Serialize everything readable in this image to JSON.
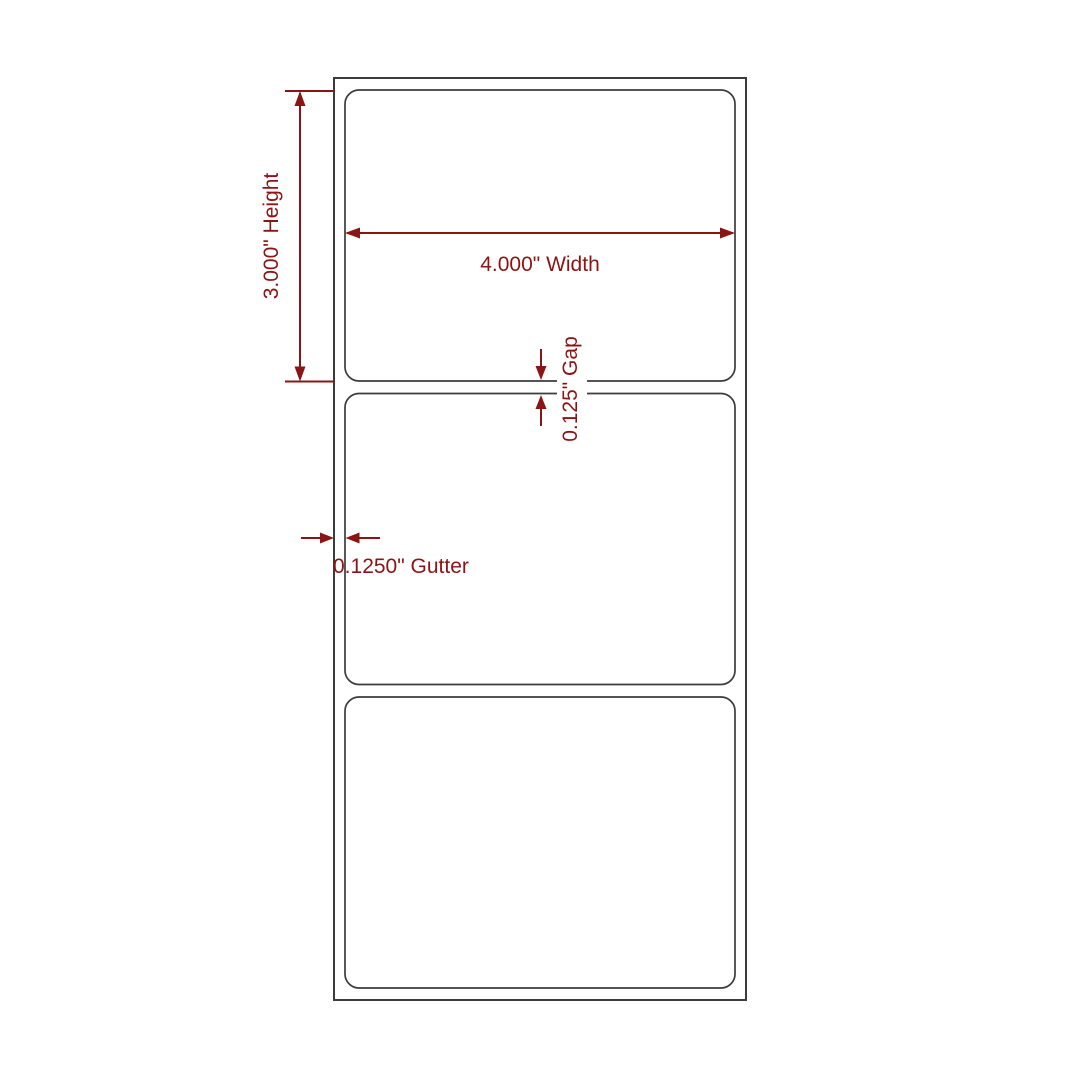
{
  "colors": {
    "dimension": "#8B1414",
    "outline": "#3c3c3c",
    "background": "#ffffff"
  },
  "diagram": {
    "name": "Label sheet dimension diagram",
    "labels_count": 3,
    "annotations": {
      "height": "3.000\" Height",
      "width": "4.000\" Width",
      "gap": "0.125\" Gap",
      "gutter": "0.1250\" Gutter"
    }
  }
}
